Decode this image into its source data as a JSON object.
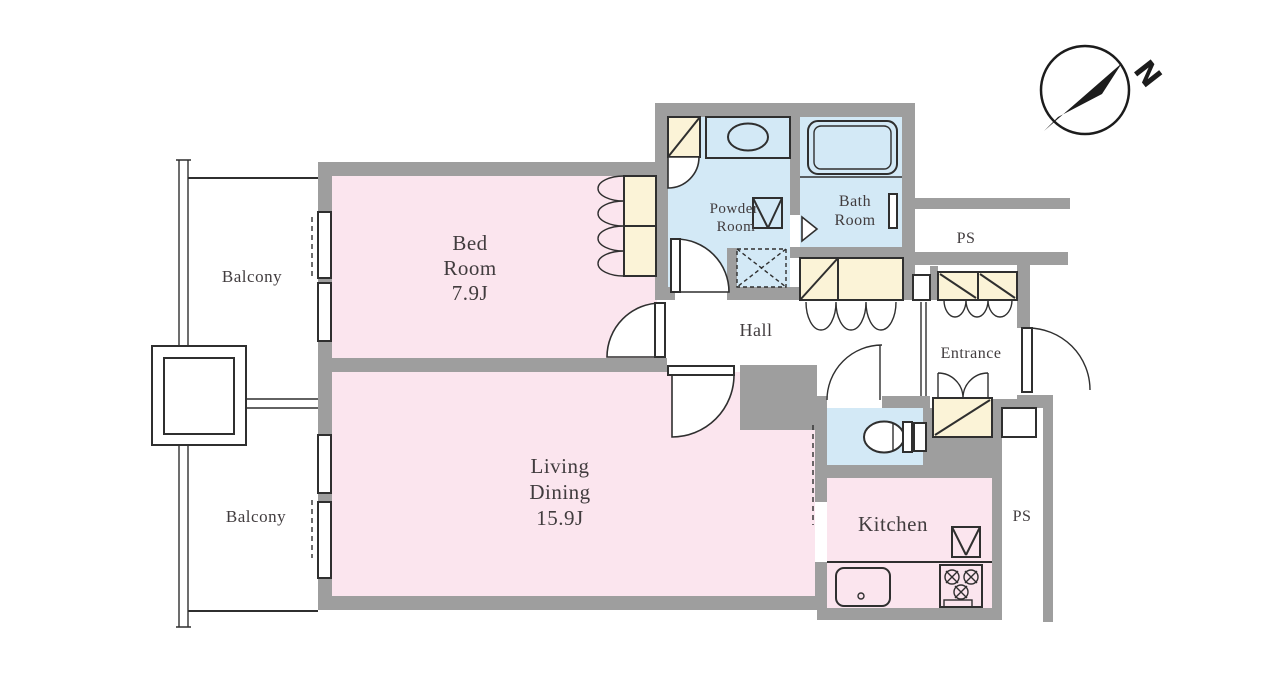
{
  "compass": {
    "north_label": "N"
  },
  "rooms": {
    "balcony_top": {
      "label": "Balcony"
    },
    "balcony_bottom": {
      "label": "Balcony"
    },
    "bedroom": {
      "line1": "Bed",
      "line2": "Room",
      "size": "7.9J"
    },
    "living_dining": {
      "line1": "Living",
      "line2": "Dining",
      "size": "15.9J"
    },
    "kitchen": {
      "label": "Kitchen"
    },
    "hall": {
      "label": "Hall"
    },
    "entrance": {
      "label": "Entrance"
    },
    "powder_room": {
      "line1": "Powder",
      "line2": "Room"
    },
    "bath_room": {
      "line1": "Bath",
      "line2": "Room"
    },
    "ps_upper": {
      "label": "PS"
    },
    "ps_lower": {
      "label": "PS"
    }
  },
  "colors": {
    "wall-color": "#9e9e9e",
    "room-pink": "#fbe5ee",
    "wet-blue": "#d3e9f6",
    "closet-cream": "#fbf3d7",
    "line-color": "#2f2f2f",
    "text-color": "#413c3e"
  }
}
